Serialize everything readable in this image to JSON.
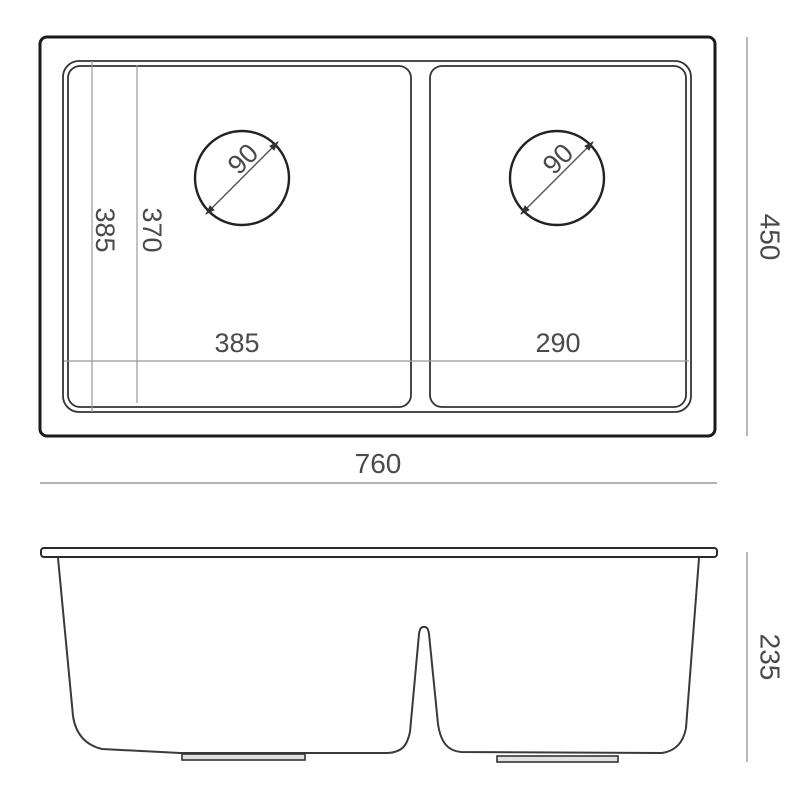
{
  "drawing": {
    "title": "double-bowl-sink-technical-drawing",
    "top_view": {
      "overall_width_label": "760",
      "overall_depth_label": "450",
      "left_bowl_width_label": "385",
      "right_bowl_width_label": "290",
      "inner_length_label": "385",
      "bowl_inner_length_label": "370",
      "left_drain_diameter_label": "90",
      "right_drain_diameter_label": "90"
    },
    "side_view": {
      "bowl_depth_label": "235"
    },
    "colors": {
      "outer_line": "#1a1a1a",
      "inner_line": "#333333",
      "thin_dim_line": "#9a9a9a",
      "text": "#4a4a4a",
      "foot_fill": "#e2e2e2"
    }
  }
}
